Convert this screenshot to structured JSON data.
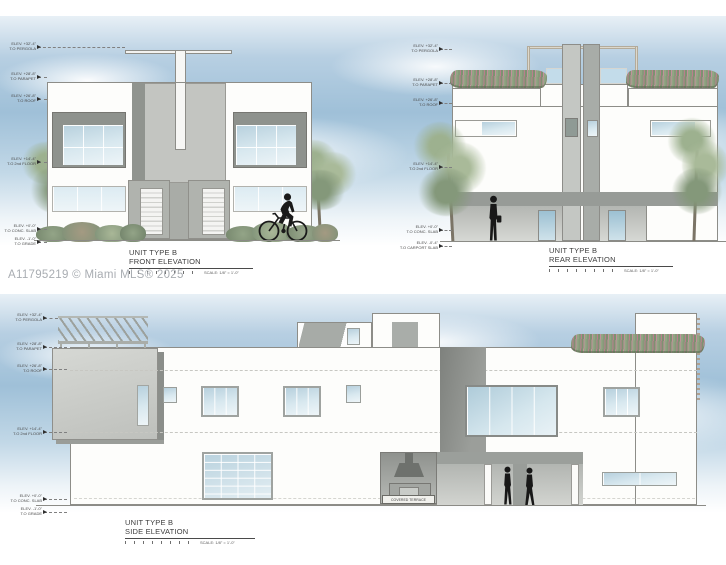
{
  "watermark": "A11795219 © Miami MLS® 2025",
  "colors": {
    "sky_blue": "#9fc0d8",
    "drawing_gray": "#c3c5c1",
    "dark_gray": "#8e928e",
    "glass_blue": "#c6dce8",
    "foliage_green": "#8fa383",
    "flower_pink": "#b97f8d",
    "figure_black": "#1a1a1a",
    "watermark_gray": "#a9adb2",
    "annotation_gray": "#4a4a4a"
  },
  "panels": {
    "front": {
      "title1": "UNIT TYPE B",
      "title2": "FRONT ELEVATION",
      "scale": "SCALE: 1/8\" = 1'-0\"",
      "markers": [
        {
          "l1": "ELEV. +32'-4\"",
          "l2": "T.O PERGOLA"
        },
        {
          "l1": "ELEV. +28'-8\"",
          "l2": "T.O PARAPET"
        },
        {
          "l1": "ELEV. +26'-8\"",
          "l2": "T.O ROOF"
        },
        {
          "l1": "ELEV. +14'-4\"",
          "l2": "T.O 2nd FLOOR"
        },
        {
          "l1": "ELEV. +0'-0\"",
          "l2": "T.O CONC. SLAB"
        },
        {
          "l1": "ELEV. -1'-0\"",
          "l2": "T.O GRADE"
        }
      ]
    },
    "rear": {
      "title1": "UNIT TYPE B",
      "title2": "REAR ELEVATION",
      "scale": "SCALE: 1/8\" = 1'-0\"",
      "markers": [
        {
          "l1": "ELEV. +32'-4\"",
          "l2": "T.O PERGOLA"
        },
        {
          "l1": "ELEV. +28'-8\"",
          "l2": "T.O PARAPET"
        },
        {
          "l1": "ELEV. +26'-8\"",
          "l2": "T.O ROOF"
        },
        {
          "l1": "ELEV. +14'-4\"",
          "l2": "T.O 2nd FLOOR"
        },
        {
          "l1": "ELEV. +0'-0\"",
          "l2": "T.O CONC. SLAB"
        },
        {
          "l1": "ELEV. -0'-4\"",
          "l2": "T.O CARPORT SLAB"
        }
      ]
    },
    "side": {
      "title1": "UNIT TYPE B",
      "title2": "SIDE ELEVATION",
      "scale": "SCALE: 1/8\" = 1'-0\"",
      "terrace_label": "COVERED TERRACE",
      "markers": [
        {
          "l1": "ELEV. +32'-4\"",
          "l2": "T.O PERGOLA"
        },
        {
          "l1": "ELEV. +28'-8\"",
          "l2": "T.O PARAPET"
        },
        {
          "l1": "ELEV. +26'-8\"",
          "l2": "T.O ROOF"
        },
        {
          "l1": "ELEV. +14'-4\"",
          "l2": "T.O 2nd FLOOR"
        },
        {
          "l1": "ELEV. +0'-0\"",
          "l2": "T.O CONC. SLAB"
        },
        {
          "l1": "ELEV. -1'-0\"",
          "l2": "T.O GRADE"
        }
      ]
    }
  }
}
